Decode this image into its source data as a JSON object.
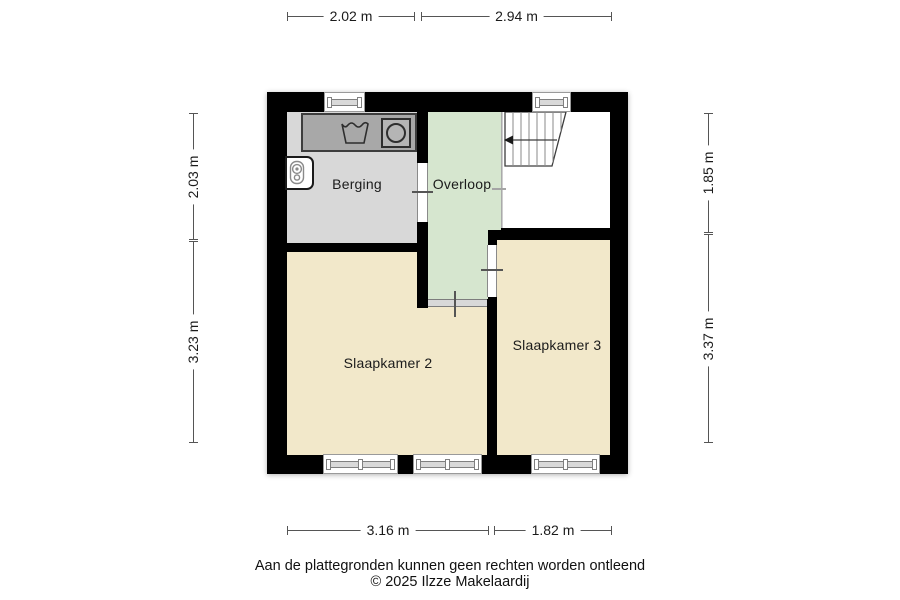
{
  "rooms": {
    "berging": {
      "label": "Berging",
      "fill": "#d8d8d8"
    },
    "overloop": {
      "label": "Overloop",
      "fill": "#d6e6cf"
    },
    "slaapkamer_2": {
      "label": "Slaapkamer 2",
      "fill": "#f2e8ca"
    },
    "slaapkamer_3": {
      "label": "Slaapkamer 3",
      "fill": "#f2e8ca"
    },
    "stairwell": {
      "fill": "#ffffff"
    }
  },
  "dimensions": {
    "top": [
      "2.02 m",
      "2.94 m"
    ],
    "bottom": [
      "3.16 m",
      "1.82 m"
    ],
    "left": [
      "2.03 m",
      "3.23 m"
    ],
    "right": [
      "1.85 m",
      "3.37 m"
    ]
  },
  "footer": {
    "disclaimer": "Aan de plattegronden kunnen geen rechten worden ontleend",
    "copyright": "© 2025 Ilzze Makelaardij"
  },
  "colors": {
    "wall": "#000000",
    "counter": "#a8a8a8",
    "window_frame": "#9a9a9a",
    "dimension_line": "#555555"
  },
  "icons": {
    "sink": "sink-icon",
    "washing_machine": "washing-machine-icon",
    "boiler": "boiler-icon",
    "stairs": "stairs-icon",
    "stairs_arrow": "stairs-direction-arrow"
  }
}
